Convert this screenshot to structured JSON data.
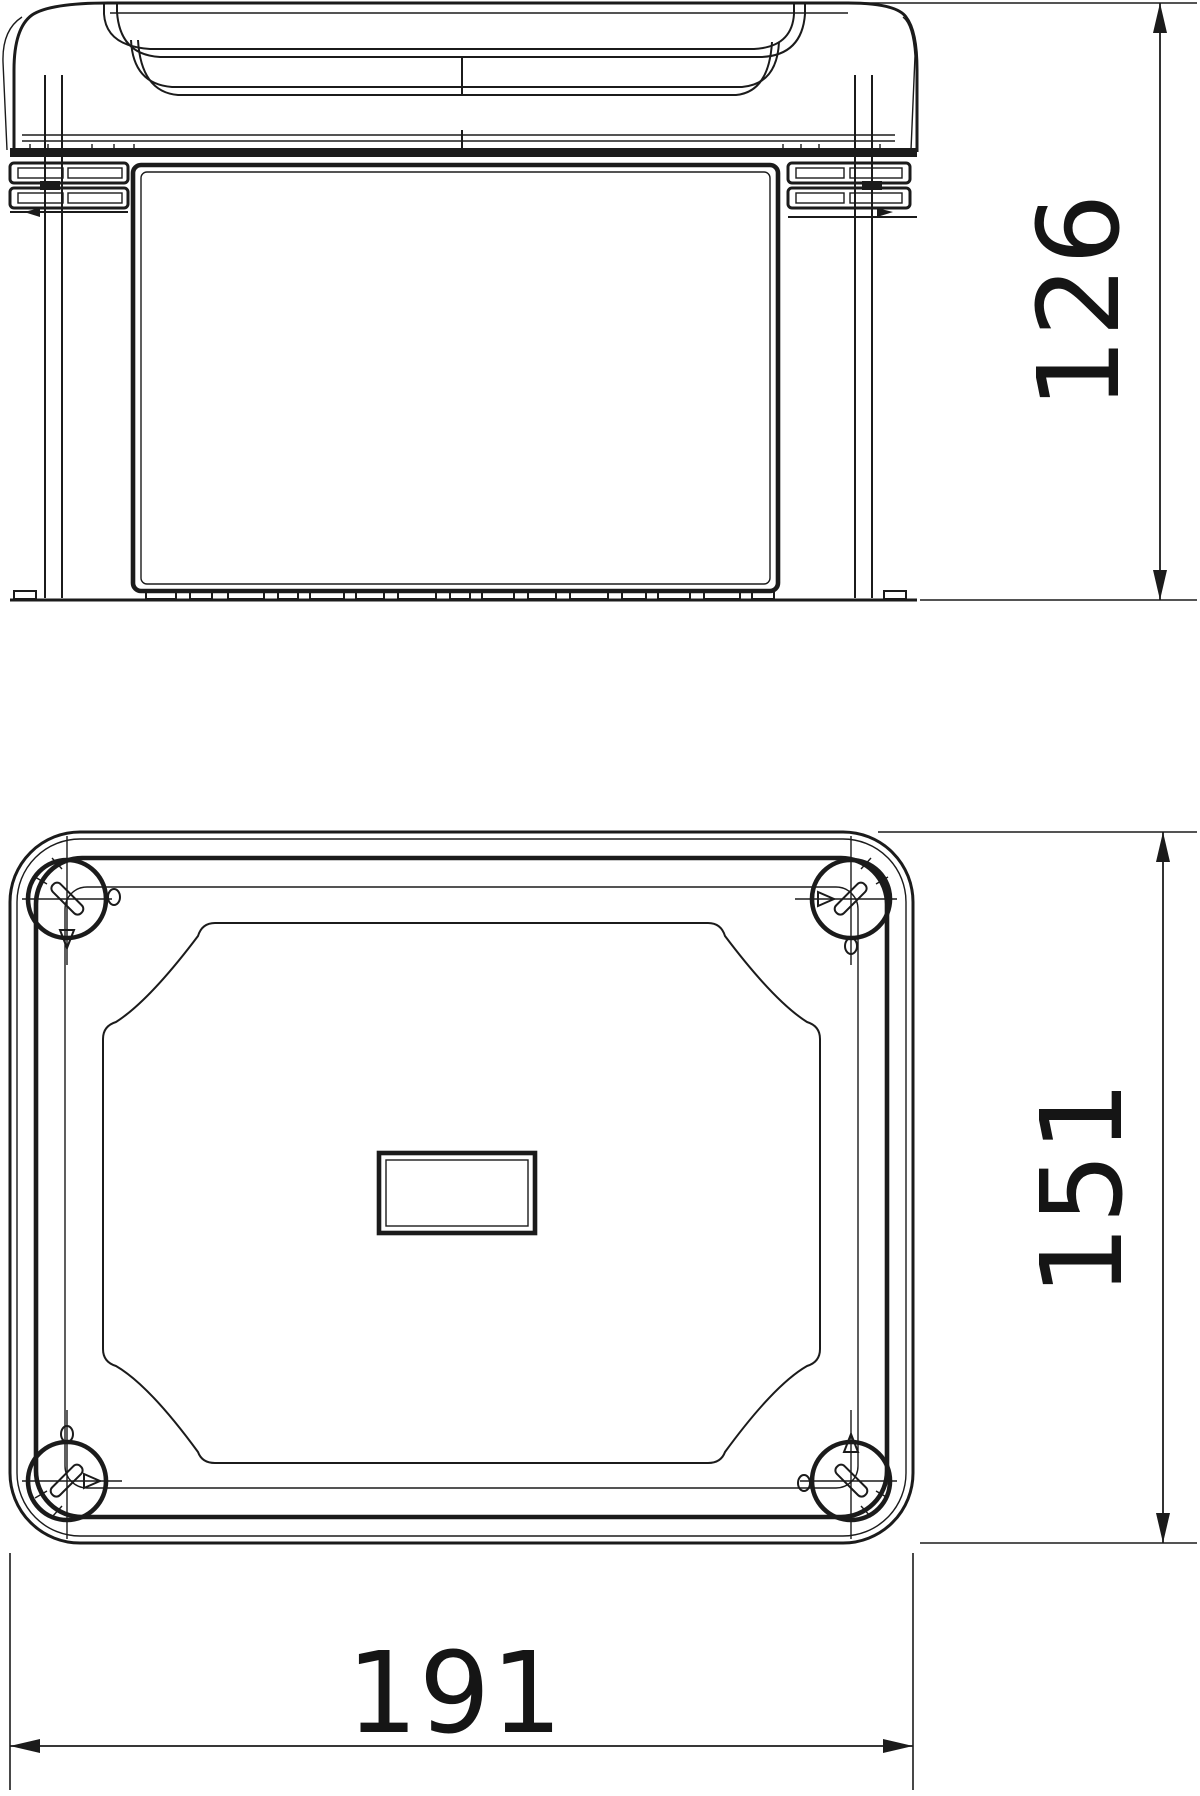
{
  "drawing": {
    "background": "#ffffff",
    "ink": "#1b1b1b",
    "views": {
      "front": {
        "name": "front-elevation-view"
      },
      "plan": {
        "name": "top-plan-view"
      }
    }
  },
  "dimensions": {
    "height": {
      "value": "126",
      "orientation": "vertical",
      "location": "right-of-front-view"
    },
    "depth": {
      "value": "151",
      "orientation": "vertical",
      "location": "right-of-plan-view"
    },
    "width": {
      "value": "191",
      "orientation": "horizontal",
      "location": "below-plan-view"
    }
  }
}
